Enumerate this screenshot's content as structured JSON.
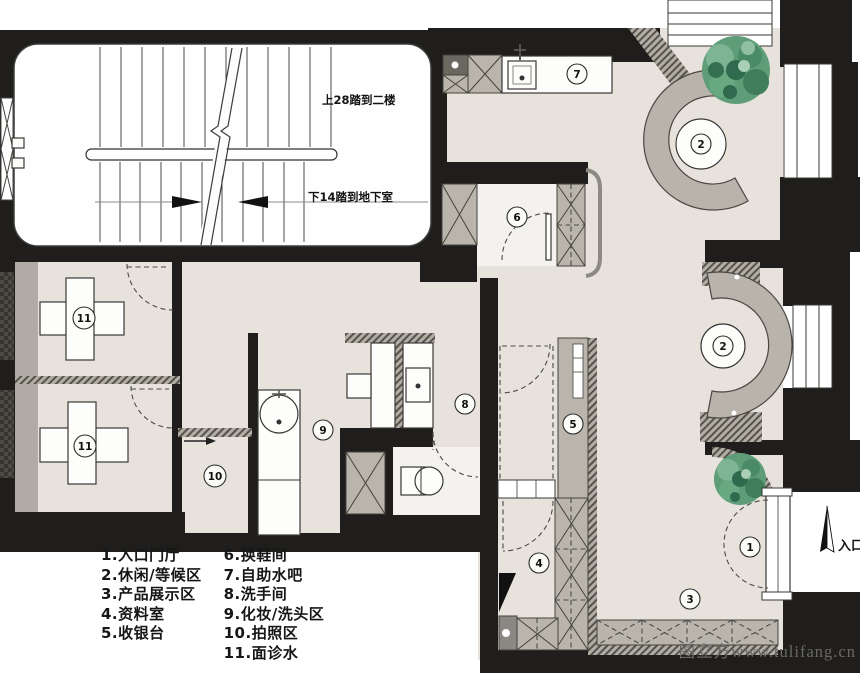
{
  "legend": {
    "column1": [
      "1.入口门厅",
      "2.休闲/等候区",
      "3.产品展示区",
      "4.资料室",
      "5.收银台"
    ],
    "column2": [
      "6.换鞋间",
      "7.自助水吧",
      "8.洗手间",
      "9.化妆/洗头区",
      "10.拍照区",
      "11.面诊水"
    ]
  },
  "annotations": {
    "stairs_up": "上28踏到二楼",
    "stairs_down": "下14踏到地下室",
    "entrance": "入口"
  },
  "badges": [
    "1",
    "2",
    "2",
    "3",
    "4",
    "5",
    "6",
    "7",
    "8",
    "9",
    "10",
    "11",
    "11"
  ],
  "watermark": "图立方www.tulifang.cn",
  "colors": {
    "wall": "#1f1e1c",
    "floor": "#e7e3dc",
    "furniture": "#b9b5ad",
    "tree": "#4d8f6b"
  }
}
